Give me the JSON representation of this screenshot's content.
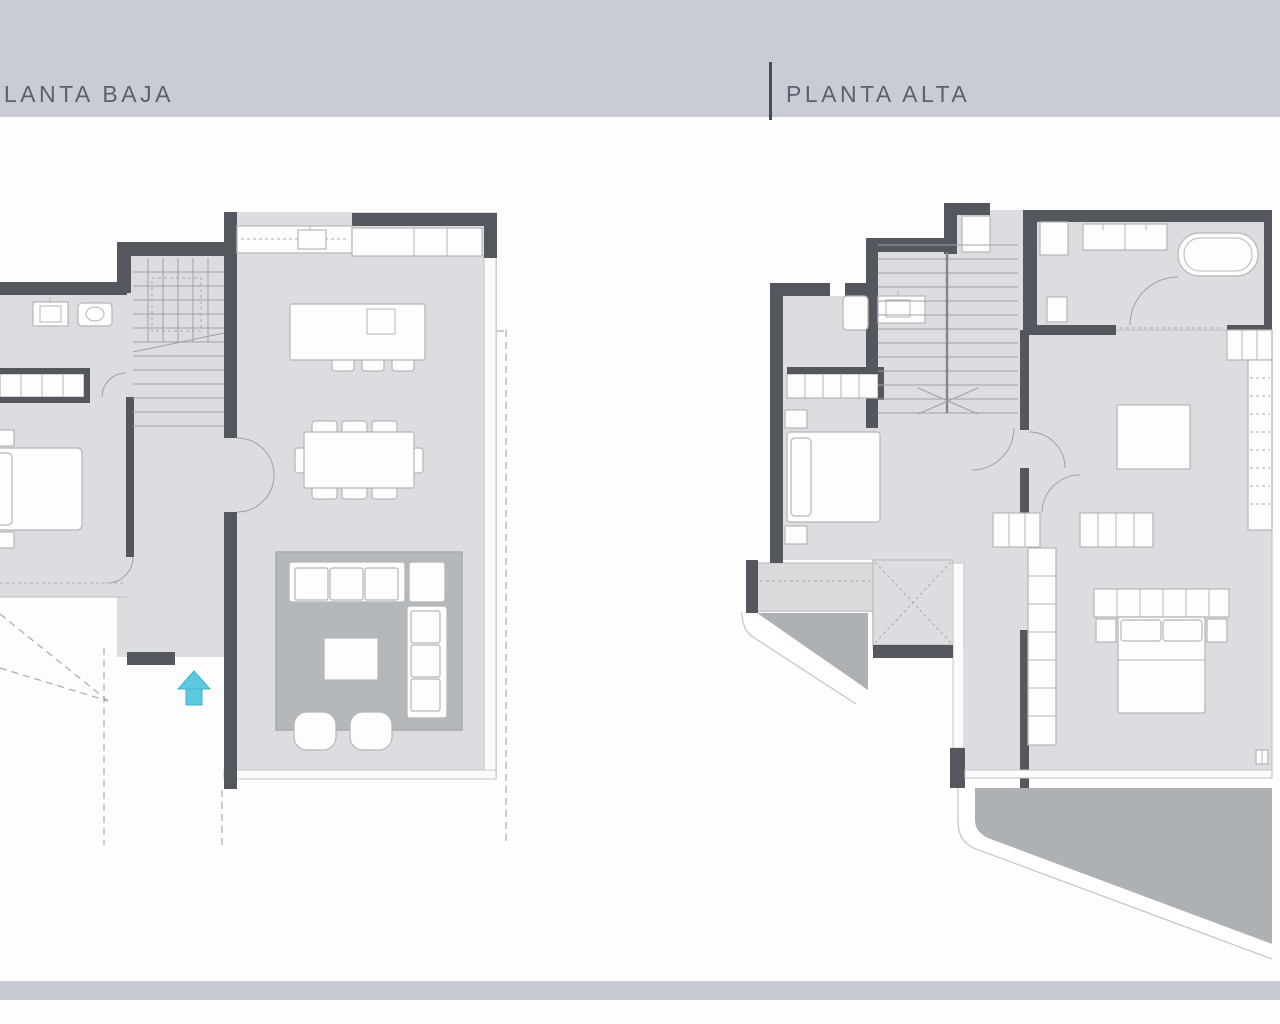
{
  "header": {
    "left_plan_title": "PLANTA BAJA",
    "right_plan_title": "PLANTA ALTA"
  },
  "plans": [
    {
      "id": "planta-baja",
      "title": "PLANTA BAJA",
      "features": [
        "staircase",
        "hallway",
        "bathroom-sink",
        "toilet",
        "wardrobe",
        "bed",
        "kitchen-counter",
        "cooktop",
        "kitchen-island",
        "island-sink",
        "bar-stools",
        "dining-table",
        "dining-chairs",
        "living-rug",
        "corner-sofa",
        "coffee-table",
        "poufs",
        "entrance-arrow"
      ]
    },
    {
      "id": "planta-alta",
      "title": "PLANTA ALTA",
      "features": [
        "staircase",
        "bathroom",
        "bathtub",
        "double-sink",
        "toilet",
        "wash-basin",
        "wardrobe",
        "bed",
        "balcony",
        "terrace",
        "x-closet",
        "master-bedroom",
        "desk",
        "dresser",
        "master-bed",
        "nightstands",
        "walk-in-closet"
      ]
    }
  ],
  "icons": {
    "entrance_arrow": "up-arrow"
  },
  "theme": {
    "background": "#fdfdfd",
    "header_band": "#c9ccd3",
    "footer_band": "#c7cad1",
    "title_text": "#596170",
    "divider": "#454c57",
    "wall": "#54585e",
    "floor": "#dcdde0",
    "floor_light": "#d9dadc",
    "rug": "#b5b8bb",
    "terrace": "#aeb1b4",
    "furniture_fill": "#fdfdfd",
    "furniture_stroke": "#b3b6b9",
    "stair_line": "#9ea1a5",
    "dash_line": "#a8abae",
    "arrow_fill": "#5bc9dd",
    "arrow_stroke": "#3fb3c9"
  }
}
